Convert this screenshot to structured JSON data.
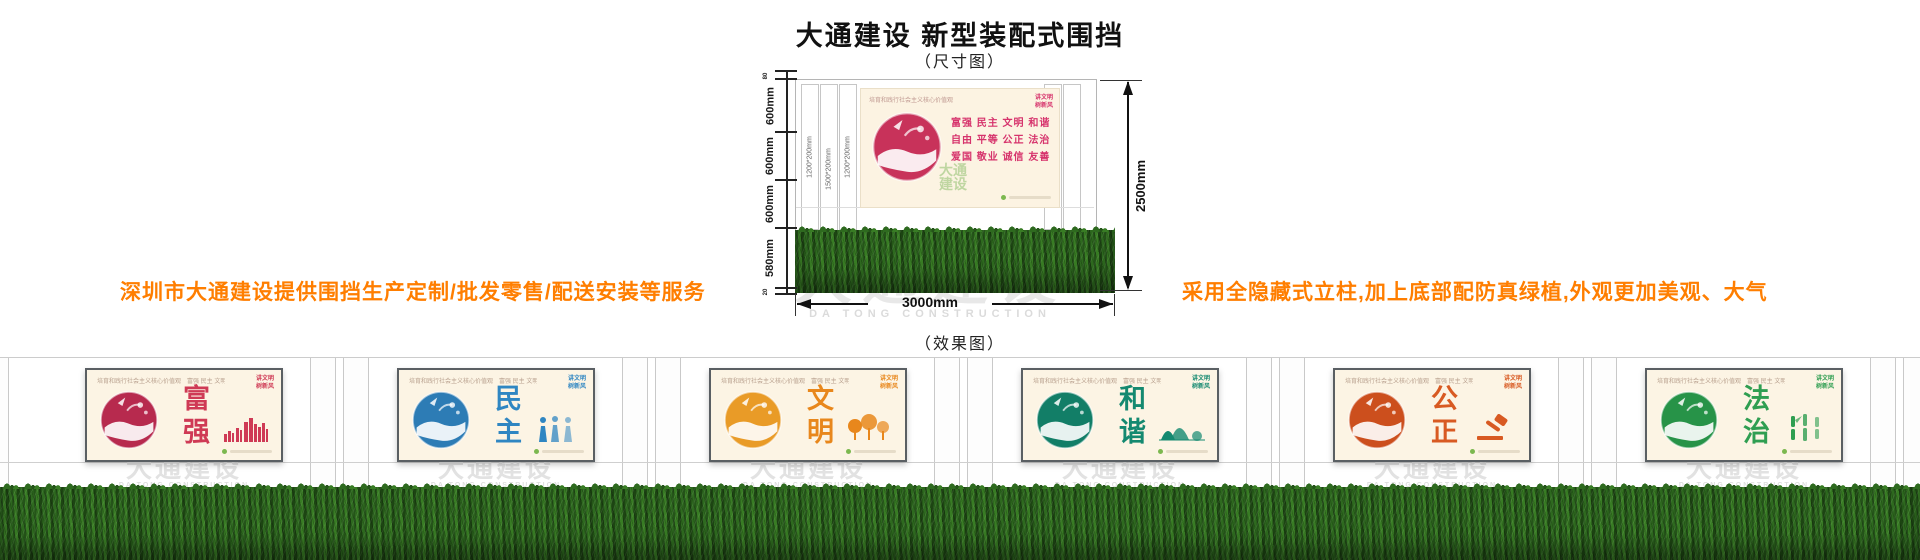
{
  "page_title": "大通建设 新型装配式围挡",
  "dimension_caption": "（尺寸图）",
  "effect_caption": "（效果图）",
  "left_note": "深圳市大通建设提供围挡生产定制/批发零售/配送安装等服务",
  "right_note": "采用全隐藏式立柱,加上底部配防真绿植,外观更加美观、大气",
  "note_color": "#ff7e00",
  "brand_watermark": {
    "cn": "大通建设",
    "en": "DA TONG CONSTRUCTION"
  },
  "diagram": {
    "segment_labels": [
      "600mm",
      "600mm",
      "600mm",
      "580mm"
    ],
    "top_offset": "80",
    "bottom_offset": "20",
    "post_sizes": [
      "1200*200mm",
      "1500*200mm",
      "1200*200mm"
    ],
    "total_height": "2500mm",
    "total_width": "3000mm",
    "banner": {
      "header": "培育和践行社会主义核心价值观",
      "value_rows": [
        "富强 民主 文明 和谐",
        "自由 平等 公正 法治",
        "爱国 敬业 诚信 友善"
      ],
      "badge_line1": "讲文明",
      "badge_line2": "树新风",
      "accent": "#d6336c",
      "circle": "#c8325a",
      "inner_watermark_line1": "大通",
      "inner_watermark_line2": "建设"
    }
  },
  "effect": {
    "header_strip": "培育和践行社会主义核心价值观　富强 民主 文明 和谐 自由 平等 公正 法治 爱国 敬业 诚信 友善",
    "badge_line1": "讲文明",
    "badge_line2": "树新风",
    "panels": [
      {
        "word": "富强",
        "accent": "#cf3a55",
        "circle": "#b72a4e",
        "icon": "city-bars-icon"
      },
      {
        "word": "民主",
        "accent": "#2f86c2",
        "circle": "#2d7cb5",
        "icon": "people-icon"
      },
      {
        "word": "文明",
        "accent": "#e8871c",
        "circle": "#e99b27",
        "icon": "trees-icon"
      },
      {
        "word": "和谐",
        "accent": "#148970",
        "circle": "#127e67",
        "icon": "mountains-icon"
      },
      {
        "word": "公正",
        "accent": "#d85a22",
        "circle": "#cc4f1d",
        "icon": "gavel-icon"
      },
      {
        "word": "法治",
        "accent": "#2f9e51",
        "circle": "#279348",
        "icon": "bamboo-icon"
      }
    ]
  },
  "grass_colors": {
    "dark": "#1d4513",
    "mid": "#25541a",
    "light": "#387c24"
  }
}
